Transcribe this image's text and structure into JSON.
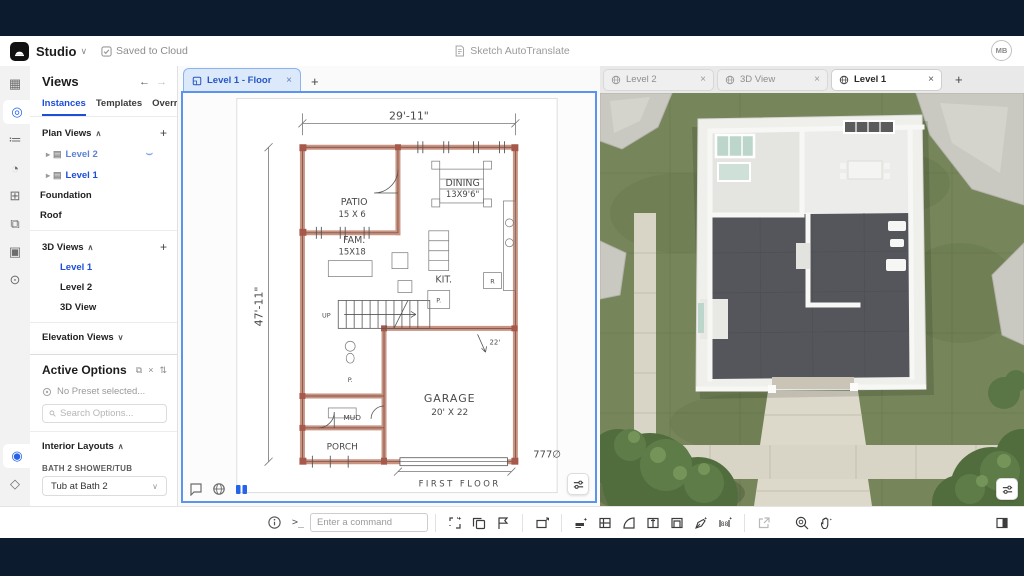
{
  "colors": {
    "accent": "#2563eb",
    "frame": "#0d1b2e",
    "wall_sketch": "#c0806c",
    "active_tab_bg": "#dce9fb",
    "grass": "#76865a"
  },
  "header": {
    "app_name": "Studio",
    "saved_status": "Saved to Cloud",
    "center_status": "Sketch AutoTranslate",
    "avatar_initials": "MB"
  },
  "rail": {
    "icons": [
      {
        "name": "sheets-icon",
        "glyph": "▦"
      },
      {
        "name": "views-icon",
        "glyph": "◎"
      },
      {
        "name": "checklist-icon",
        "glyph": "≔"
      },
      {
        "name": "globe-icon",
        "glyph": "◔"
      },
      {
        "name": "grid-icon",
        "glyph": "⊞"
      },
      {
        "name": "layers-icon",
        "glyph": "⧉"
      },
      {
        "name": "image-icon",
        "glyph": "▣"
      },
      {
        "name": "pin-icon",
        "glyph": "⊙"
      },
      {
        "name": "options-icon",
        "glyph": "◉"
      },
      {
        "name": "box-icon",
        "glyph": "◇"
      }
    ]
  },
  "views_panel": {
    "title": "Views",
    "back_arrow": "←",
    "forward_arrow": "→",
    "tabs": [
      {
        "label": "Instances",
        "active": true
      },
      {
        "label": "Templates",
        "active": false
      },
      {
        "label": "Overrides",
        "active": false
      }
    ],
    "plan_views": {
      "label": "Plan Views",
      "items": [
        {
          "label": "Level 2"
        },
        {
          "label": "Level 1"
        },
        {
          "label": "Foundation"
        },
        {
          "label": "Roof"
        }
      ]
    },
    "three_d_views": {
      "label": "3D Views",
      "items": [
        {
          "label": "Level 1"
        },
        {
          "label": "Level 2"
        },
        {
          "label": "3D View"
        }
      ]
    },
    "elevation_views": {
      "label": "Elevation Views"
    }
  },
  "active_options": {
    "title": "Active Options",
    "preset_text": "No Preset selected...",
    "search_placeholder": "Search Options...",
    "section_label": "Interior Layouts",
    "fields": [
      {
        "label": "BATH 2 SHOWER/TUB",
        "value": "Tub at Bath 2"
      },
      {
        "label": "BATH 3 LAYOUT",
        "value": "Tub at Bath 3"
      }
    ]
  },
  "center_pane": {
    "tab_label": "Level 1 - Floor",
    "plan": {
      "dim_top": "29'-11\"",
      "dim_left": "47'-11\"",
      "patio": "PATIO",
      "patio_size": "15 X 6",
      "dining": "DINING",
      "dining_size": "13X9'6\"",
      "fam": "FAM.",
      "fam_size": "15X18",
      "kit": "KIT.",
      "up": "UP",
      "pantry": "P.",
      "bath": "P.",
      "fridge": "R",
      "mud": "MUD",
      "porch": "PORCH",
      "garage": "GARAGE",
      "garage_size": "20' X 22",
      "dim_22": "22'",
      "area": "777∅",
      "caption": "FIRST FLOOR"
    }
  },
  "right_pane": {
    "tabs": [
      {
        "label": "Level 2",
        "active": false
      },
      {
        "label": "3D View",
        "active": false
      },
      {
        "label": "Level 1",
        "active": true
      }
    ]
  },
  "toolbar": {
    "command_placeholder": "Enter a command"
  }
}
